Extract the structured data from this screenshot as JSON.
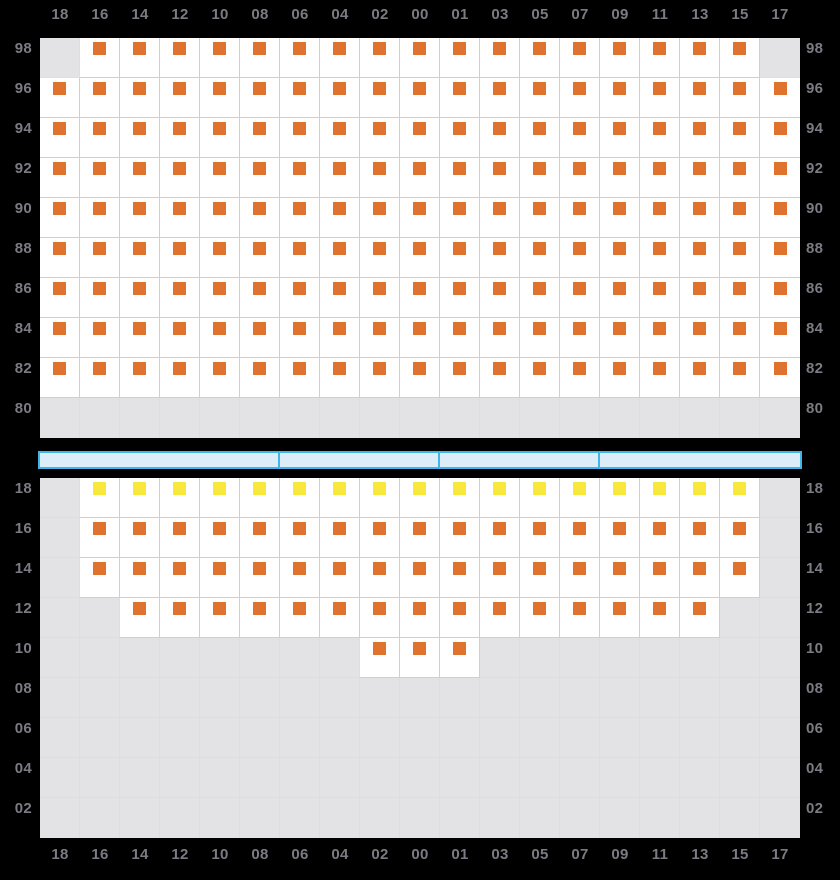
{
  "columns": [
    "18",
    "16",
    "14",
    "12",
    "10",
    "08",
    "06",
    "04",
    "02",
    "00",
    "01",
    "03",
    "05",
    "07",
    "09",
    "11",
    "13",
    "15",
    "17"
  ],
  "top_panel": {
    "row_labels": [
      "98",
      "96",
      "94",
      "92",
      "90",
      "88",
      "86",
      "84",
      "82",
      "80"
    ],
    "rows": [
      {
        "label": "98",
        "cells": "GOOOOOOOOOOOOOOOOOG"
      },
      {
        "label": "96",
        "cells": "OOOOOOOOOOOOOOOOOOO"
      },
      {
        "label": "94",
        "cells": "OOOOOOOOOOOOOOOOOOO"
      },
      {
        "label": "92",
        "cells": "OOOOOOOOOOOOOOOOOOO"
      },
      {
        "label": "90",
        "cells": "OOOOOOOOOOOOOOOOOOO"
      },
      {
        "label": "88",
        "cells": "OOOOOOOOOOOOOOOOOOO"
      },
      {
        "label": "86",
        "cells": "OOOOOOOOOOOOOOOOOOO"
      },
      {
        "label": "84",
        "cells": "OOOOOOOOOOOOOOOOOOO"
      },
      {
        "label": "82",
        "cells": "OOOOOOOOOOOOOOOOOOO"
      },
      {
        "label": "80",
        "cells": "GGGGGGGGGGGGGGGGGGG"
      }
    ]
  },
  "bottom_panel": {
    "row_labels": [
      "18",
      "16",
      "14",
      "12",
      "10",
      "08",
      "06",
      "04",
      "02"
    ],
    "rows": [
      {
        "label": "18",
        "cells": "GYYYYYYYYYYYYYYYYYG"
      },
      {
        "label": "16",
        "cells": "GOOOOOOOOOOOOOOOOOG"
      },
      {
        "label": "14",
        "cells": "GOOOOOOOOOOOOOOOOOG"
      },
      {
        "label": "12",
        "cells": "GGOOOOOOOOOOOOOOOGG"
      },
      {
        "label": "10",
        "cells": "GGGGGGGGOOOGGGGGGGG"
      },
      {
        "label": "08",
        "cells": "GGGGGGGGGGGGGGGGGGG"
      },
      {
        "label": "06",
        "cells": "GGGGGGGGGGGGGGGGGGG"
      },
      {
        "label": "04",
        "cells": "GGGGGGGGGGGGGGGGGGG"
      },
      {
        "label": "02",
        "cells": "GGGGGGGGGGGGGGGGGGG"
      }
    ]
  },
  "scrollbar": {
    "segments": [
      {
        "span_cols": 6
      },
      {
        "span_cols": 4
      },
      {
        "span_cols": 4
      },
      {
        "span_cols": 5
      }
    ]
  },
  "cell_legend": {
    "O": "orange-marker",
    "Y": "yellow-marker",
    "G": "gray-disabled"
  },
  "colors": {
    "background": "#000000",
    "cell_white": "#ffffff",
    "cell_gray": "#e3e3e6",
    "grid_line": "#cfcfd3",
    "grid_line_gray": "#dedee2",
    "marker_orange": "#e0722f",
    "marker_yellow": "#f9e83c",
    "label_gray": "#7b7b83",
    "bar_fill": "#dcedfa",
    "bar_border": "#41b5e9"
  }
}
